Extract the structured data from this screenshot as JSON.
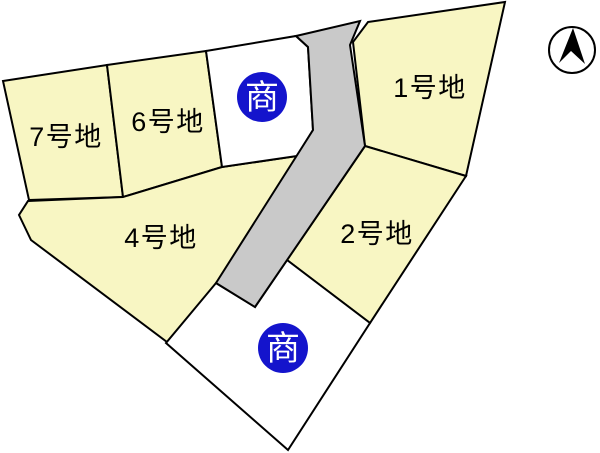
{
  "page_title": "分譲地区画図",
  "colors": {
    "background": "#ffffff",
    "lot_fill": "#F8F6C3",
    "commercial_lot_fill": "#ffffff",
    "road_fill": "#C9C9C9",
    "outline": "#000000",
    "commercial_marker_blue": "#1414CC",
    "marker_text": "#ffffff",
    "compass_fill": "#000000"
  },
  "map": {
    "width": 600,
    "height": 453,
    "road": {
      "points": "296,36 360,21 350,45 365,146 255,307 216,283 313,130 308,47"
    },
    "lots": [
      {
        "id": "lot-7",
        "label": "7号地",
        "type": "residential",
        "points": "3,81 107,65 123,197 29,200",
        "label_x": 66,
        "label_y": 137
      },
      {
        "id": "lot-6",
        "label": "6号地",
        "type": "residential",
        "points": "107,65 206,51 222,167 123,197",
        "label_x": 168,
        "label_y": 122
      },
      {
        "id": "lot-1",
        "label": "1号地",
        "type": "residential",
        "points": "368,22 505,2 466,176 365,146 353,42",
        "label_x": 430,
        "label_y": 88
      },
      {
        "id": "lot-2",
        "label": "2号地",
        "type": "residential",
        "points": "365,146 466,176 370,323 287,260",
        "label_x": 377,
        "label_y": 234
      },
      {
        "id": "lot-4",
        "label": "4号地",
        "type": "residential",
        "points": "28,201 123,197 222,167 297,156 217,283 167,342 31,240 19,215",
        "label_x": 161,
        "label_y": 238
      },
      {
        "id": "lot-commercial-north",
        "label": "",
        "type": "commercial",
        "points": "206,51 296,36 308,47 313,130 297,156 222,167",
        "label_x": null,
        "label_y": null
      },
      {
        "id": "lot-commercial-south",
        "label": "",
        "type": "commercial",
        "points": "166,343 216,283 255,307 287,260 370,323 288,450",
        "label_x": null,
        "label_y": null
      }
    ],
    "commercial_markers": [
      {
        "label": "商",
        "x": 262,
        "y": 97,
        "r": 25
      },
      {
        "label": "商",
        "x": 283,
        "y": 348,
        "r": 25
      }
    ],
    "compass": {
      "x": 572,
      "y": 50,
      "r": 23,
      "needle_path": "M573,28 L585,64 L571,51 L559,63 Z"
    }
  }
}
